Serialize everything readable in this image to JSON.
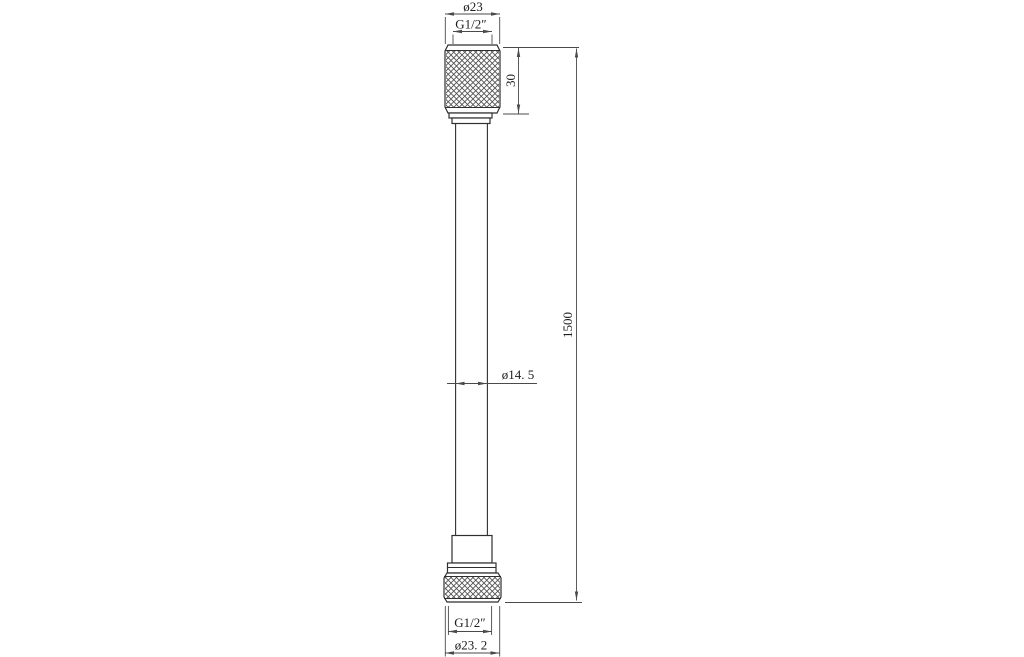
{
  "drawing": {
    "colors": {
      "background": "#ffffff",
      "part_line": "#2f2f2f",
      "dimension_line": "#4a4a4a",
      "text": "#1c1c1c"
    },
    "labels": {
      "top_outer_diameter": "ø23",
      "top_thread_size": "G1/2″",
      "top_nut_height": "30",
      "overall_length": "1500",
      "hose_outer_diameter": "ø14. 5",
      "bottom_thread_size": "G1/2″",
      "bottom_outer_diameter": "ø23. 2"
    }
  }
}
